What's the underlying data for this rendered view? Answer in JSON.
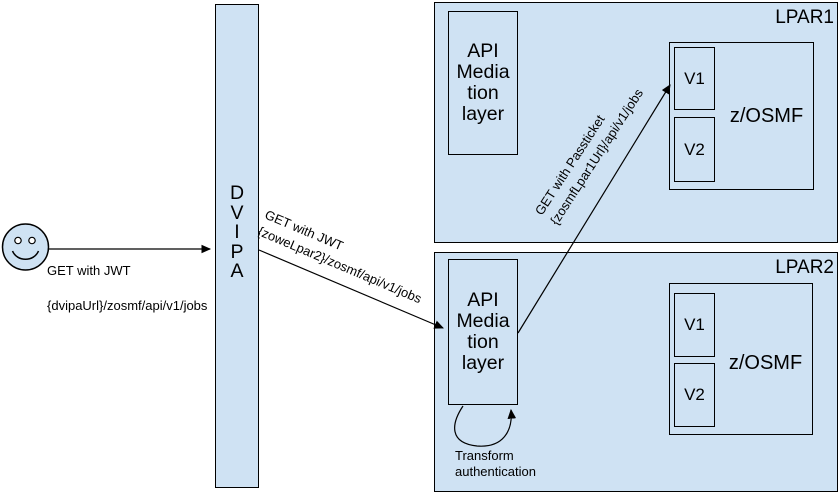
{
  "colors": {
    "box_fill": "#cfe2f3",
    "stroke": "#000000",
    "background": "#ffffff"
  },
  "user_request": {
    "line1": "GET with JWT",
    "line2": "{dvipaUrl}/zosmf/api/v1/jobs"
  },
  "dvipa": {
    "label": "D\nV\nI\nP\nA"
  },
  "route_to_lpar2": {
    "label": "GET with JWT\n{zoweLpar2}/zosmf/api/v1/jobs"
  },
  "route_passticket": {
    "label": "GET with Passticket\n{zosmfLpar1Url}/api/v1/jobs"
  },
  "lpar1": {
    "title": "LPAR1",
    "api_mediation_layer": "API\nMedia\ntion\nlayer",
    "zosmf": {
      "label": "z/OSMF",
      "v1": "V1",
      "v2": "V2"
    }
  },
  "lpar2": {
    "title": "LPAR2",
    "api_mediation_layer": "API\nMedia\ntion\nlayer",
    "zosmf": {
      "label": "z/OSMF",
      "v1": "V1",
      "v2": "V2"
    },
    "transform_note": "Transform\nauthentication"
  }
}
